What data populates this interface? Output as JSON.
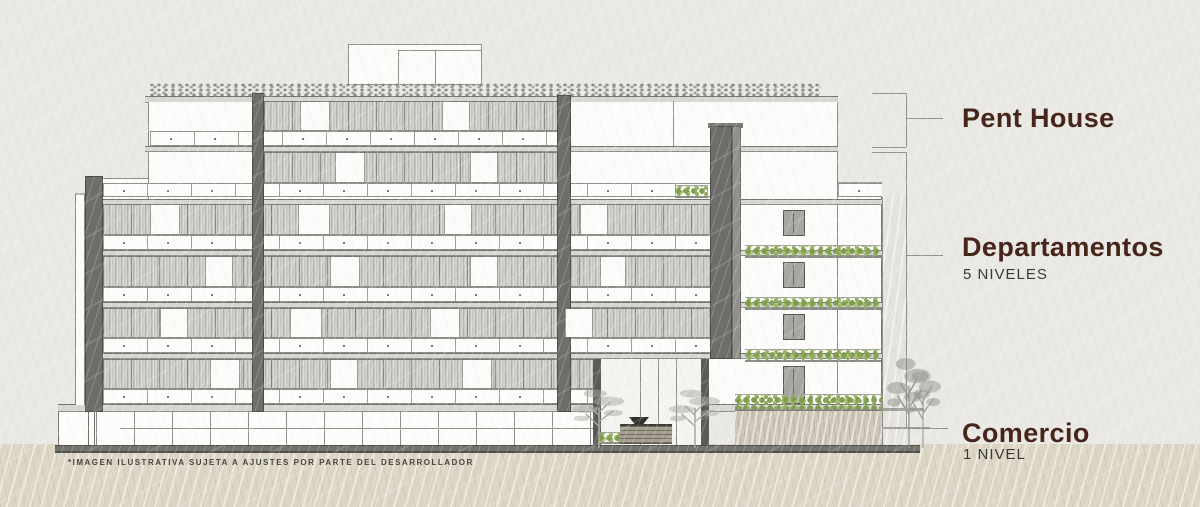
{
  "annotations": {
    "penthouse": {
      "title": "Pent House"
    },
    "departamentos": {
      "title": "Departamentos",
      "subtitle": "5 NIVELES"
    },
    "comercio": {
      "title": "Comercio",
      "subtitle": "1 NIVEL"
    }
  },
  "footnote": "*IMAGEN ILUSTRATIVA SUJETA A AJUSTES POR PARTE DEL DESARROLLADOR",
  "colors": {
    "label_accent": "#46251a",
    "sublabel_text": "#3a3933",
    "paper_background": "#eae8e4",
    "ground_band": "#ddd5c4",
    "pillar_dark": "#6d6d6a",
    "greenery": "#8fae5e",
    "tree_silhouette": "#96968f",
    "annotation_line": "#90908b"
  }
}
